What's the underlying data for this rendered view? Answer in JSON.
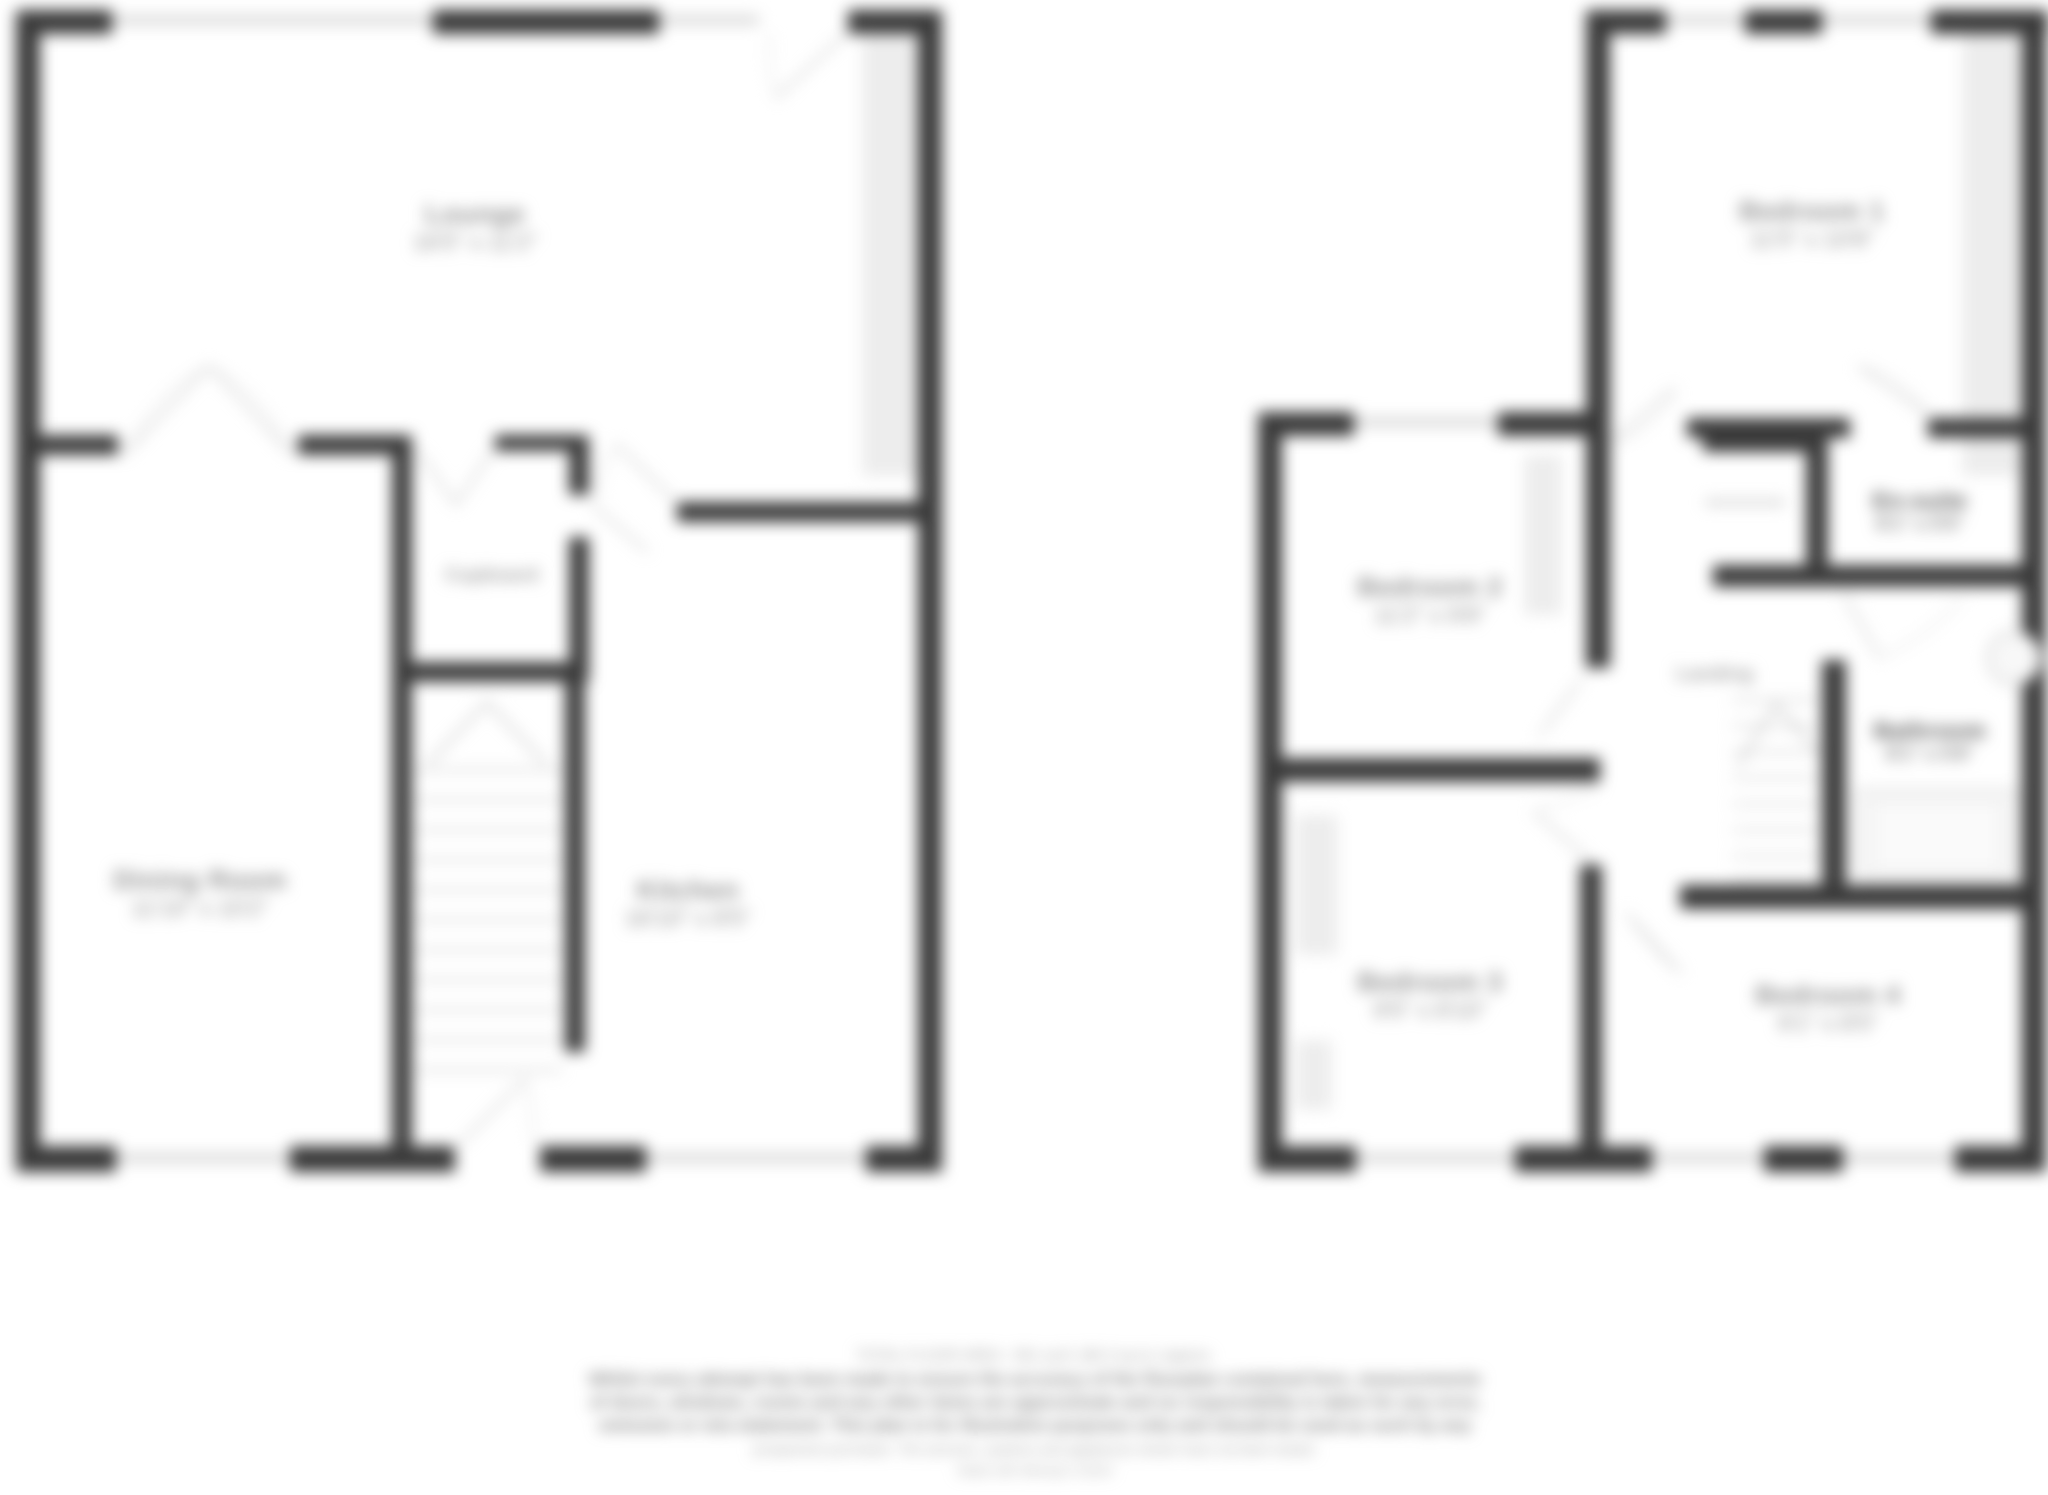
{
  "document": {
    "kind": "estate-agent floorplan, heavily blurred",
    "floors_shown": 2
  },
  "colors": {
    "background": "#ffffff",
    "wall": "#3a3a3a",
    "window_band": "#ededed",
    "window_line": "#c4c4c4",
    "door_swing": "#d2d2d2",
    "stair_tread": "#d4d4d4",
    "label_text": "#8f8f8f",
    "dark_label_text": "#565656"
  },
  "ground_floor": {
    "rooms": [
      {
        "name": "Lounge",
        "dims": "16'5\" x 11'2\""
      },
      {
        "name": "Dining Room",
        "dims": "11'10\" x 10'2\""
      },
      {
        "name": "Kitchen",
        "dims": "16'10\" x 8'5\""
      }
    ],
    "cupboard_label": "Cupboard"
  },
  "first_floor": {
    "rooms": [
      {
        "name": "Bedroom 1",
        "dims": "11'5\" x 10'8\""
      },
      {
        "name": "Bedroom 2",
        "dims": "11'2\" x 9'8\""
      },
      {
        "name": "Bedroom 3",
        "dims": "9'5\" x 8'10\""
      },
      {
        "name": "Bedroom 4",
        "dims": "9'1\" x 8'5\""
      },
      {
        "name": "Bathroom",
        "dims": "8'1\" x 5'6\""
      },
      {
        "name": "En-suite",
        "dims": "6'1\" x 5'5\""
      }
    ],
    "landing_label": "Landing"
  },
  "disclaimer": {
    "lines": [
      "TOTAL FLOOR AREA : 961 sq.ft. (89.3 sq.m.) approx.",
      "Whilst every attempt has been made to ensure the accuracy of the floorplan contained here, measurements",
      "of doors, windows, rooms and any other items are approximate and no responsibility is taken for any error,",
      "omission or mis-statement. This plan is for illustrative purposes only and should be used as such by any",
      "prospective purchaser. The services, systems and appliances shown have not been tested.",
      "Made with Metropix ©2024"
    ]
  }
}
